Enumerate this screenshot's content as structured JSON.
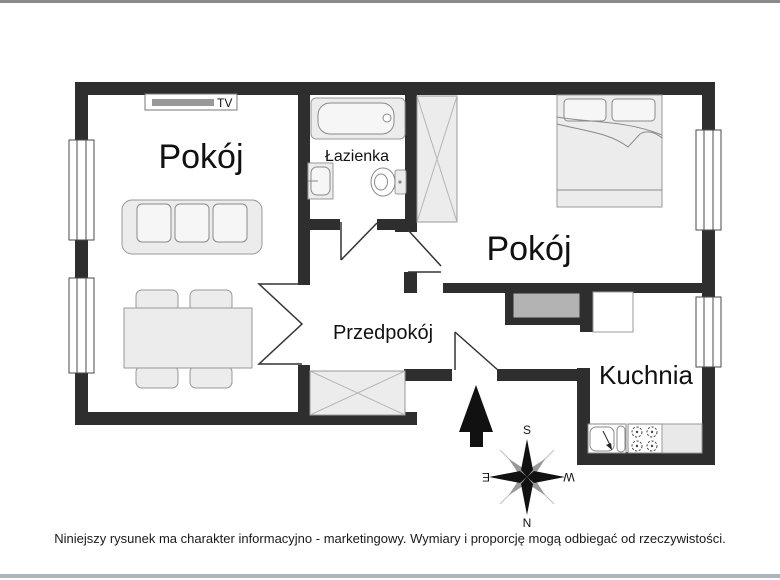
{
  "floorplan": {
    "rooms": {
      "living": {
        "label": "Pokój"
      },
      "bathroom": {
        "label": "Łazienka"
      },
      "bedroom": {
        "label": "Pokój"
      },
      "hallway": {
        "label": "Przedpokój"
      },
      "kitchen": {
        "label": "Kuchnia"
      }
    },
    "tv_label": "TV",
    "compass": {
      "top": "S",
      "bottom": "N",
      "left": "E",
      "right": "W"
    }
  },
  "footer": {
    "disclaimer": "Niniejszy rysunek ma charakter informacyjno - marketingowy. Wymiary i proporcję mogą odbiegać od rzeczywistości."
  },
  "colors": {
    "wall": "#2e2e2e",
    "furniture_fill": "#ececec",
    "cabinet_gray": "#b3b3b3",
    "frame_top": "#8a8a8a",
    "frame_bottom": "#aeb5bb"
  }
}
